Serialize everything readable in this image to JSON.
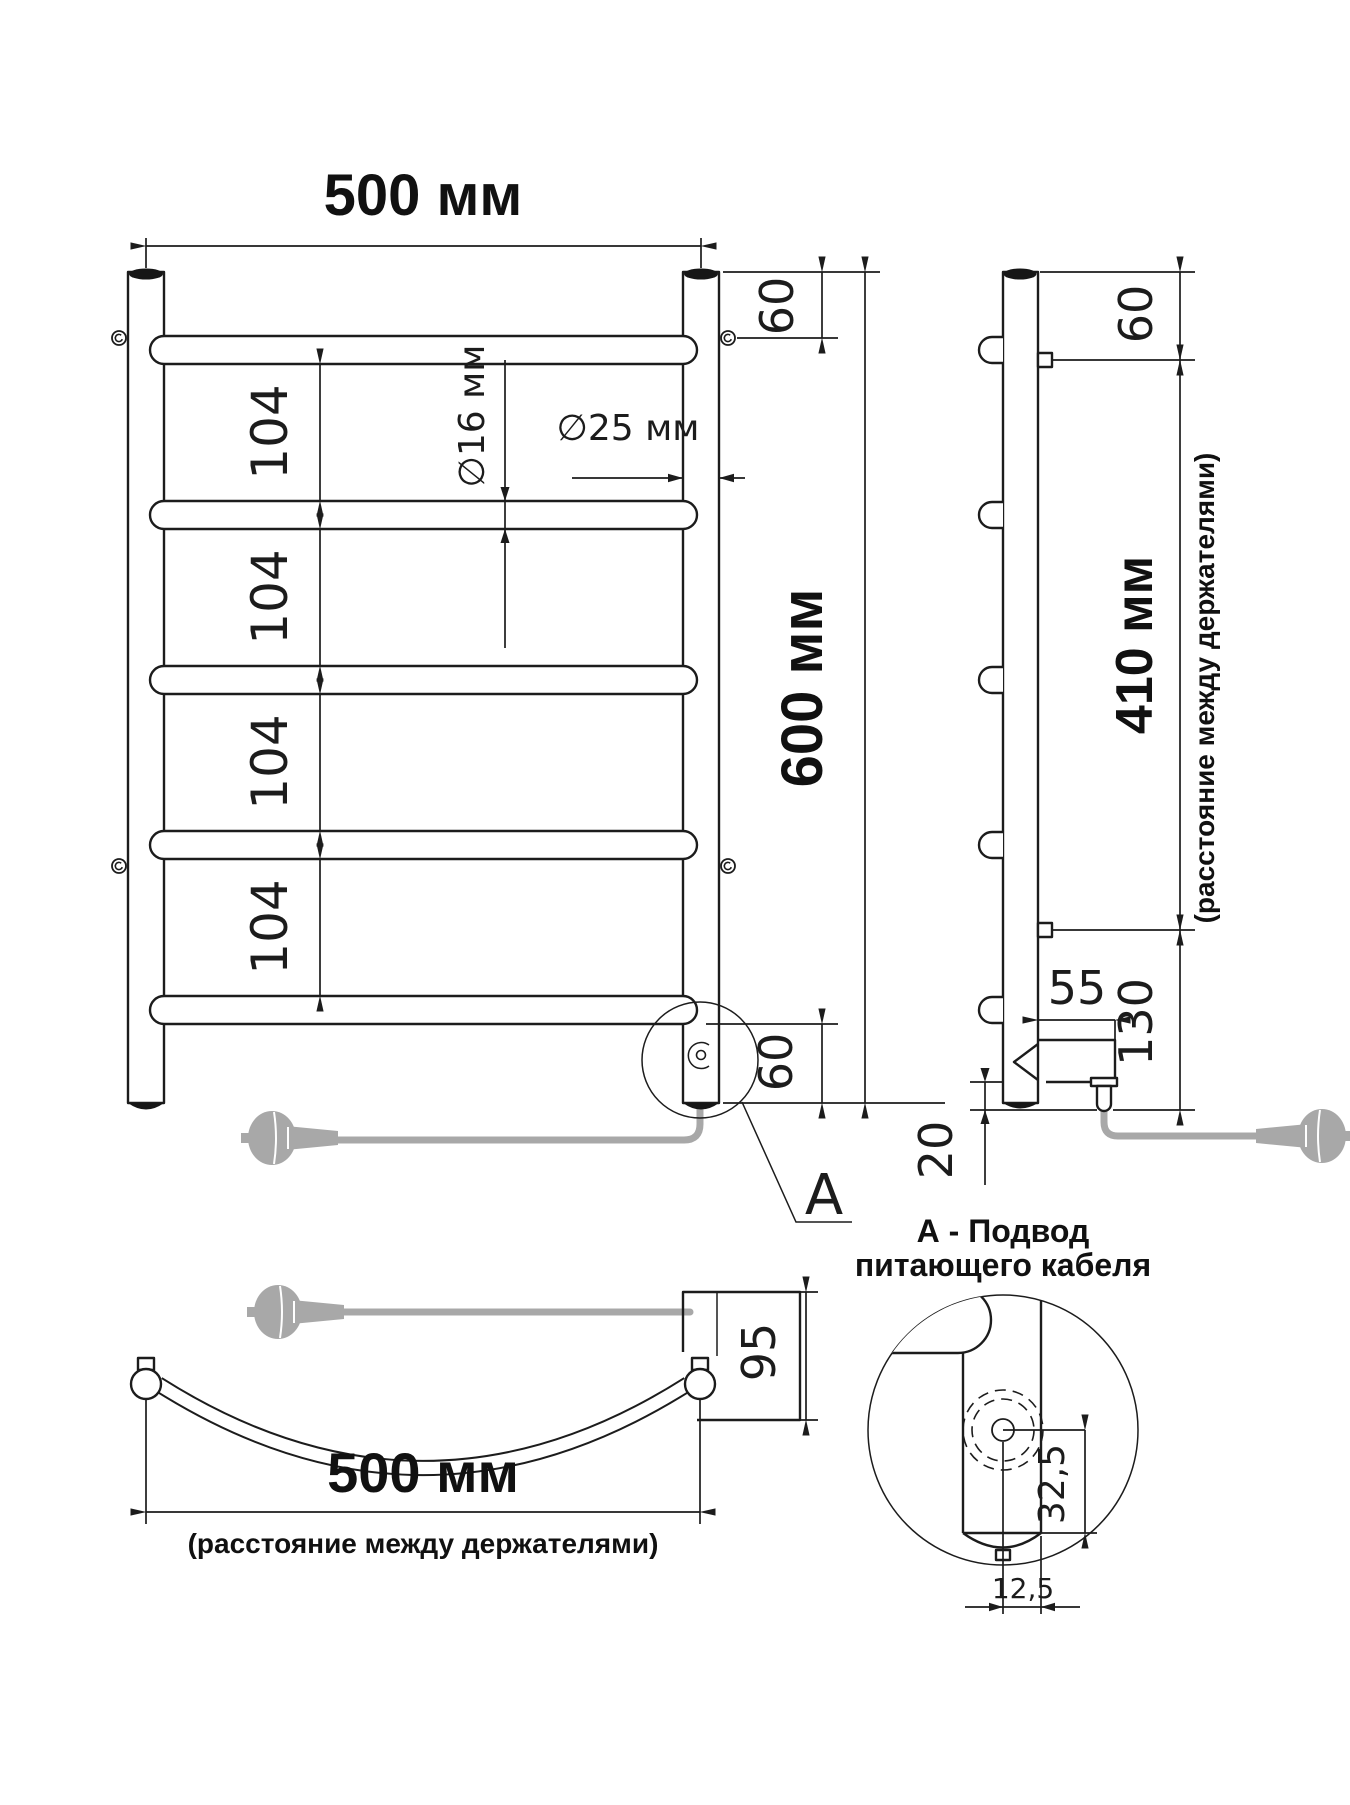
{
  "front": {
    "width": "500 мм",
    "height": "600 мм",
    "top_offset": "60",
    "bottom_offset": "60",
    "spacing": [
      "104",
      "104",
      "104",
      "104"
    ],
    "rung_diameter": "∅16 мм",
    "post_diameter": "∅25 мм",
    "detail_label": "А"
  },
  "side": {
    "top_offset": "60",
    "holders_distance": "410 мм",
    "holders_note": "(расстояние между держателями)",
    "bracket_depth": "55",
    "bottom_length": "130",
    "element_offset": "20"
  },
  "top": {
    "depth": "95",
    "holders_distance": "500 мм",
    "holders_note": "(расстояние между держателями)"
  },
  "detail": {
    "title_line1": "А - Подвод",
    "title_line2": "питающего кабеля",
    "axis_offset": "32,5",
    "cable_offset": "12,5"
  }
}
